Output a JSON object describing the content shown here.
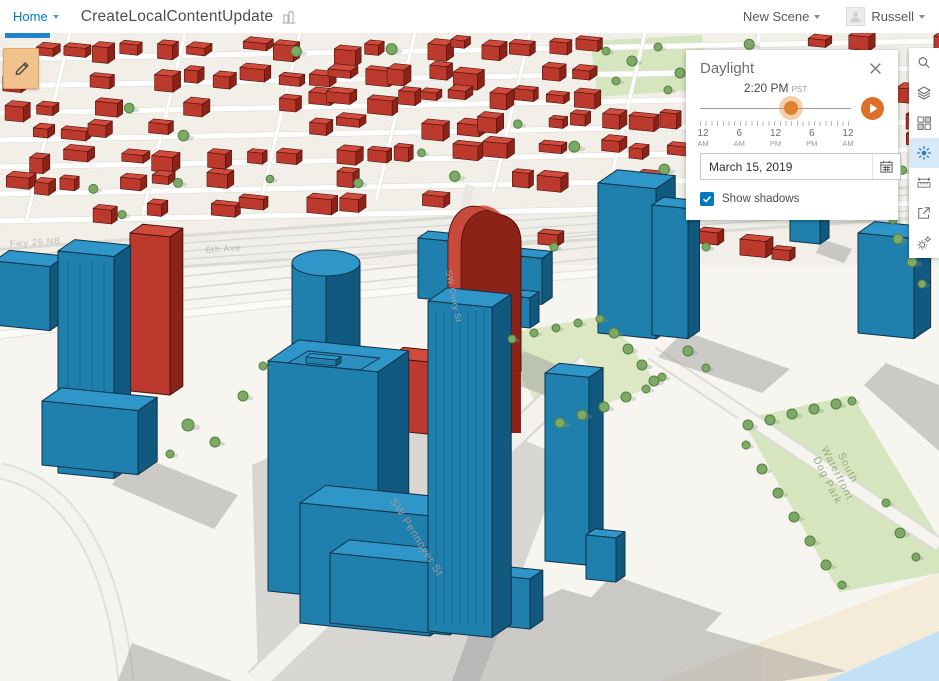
{
  "header": {
    "home_label": "Home",
    "scene_title": "CreateLocalContentUpdate",
    "new_scene_label": "New Scene",
    "user_name": "Russell"
  },
  "daylight": {
    "title": "Daylight",
    "time_value": "2:20 PM",
    "time_zone": "PST",
    "tick_labels": [
      {
        "n": "12",
        "m": "AM"
      },
      {
        "n": "6",
        "m": "AM"
      },
      {
        "n": "12",
        "m": "PM"
      },
      {
        "n": "6",
        "m": "PM"
      },
      {
        "n": "12",
        "m": "AM"
      }
    ],
    "date_value": "March 15, 2019",
    "show_shadows_label": "Show shadows"
  },
  "toolbar": {
    "items": [
      {
        "icon": "search-icon"
      },
      {
        "icon": "layers-icon"
      },
      {
        "icon": "basemap-icon"
      },
      {
        "icon": "daylight-icon",
        "active": true
      },
      {
        "icon": "measure-icon"
      },
      {
        "icon": "share-icon"
      },
      {
        "icon": "settings-icon"
      }
    ]
  },
  "scene": {
    "street_labels": {
      "freeway": "Fwy 26 NB",
      "ave": "6th Ave",
      "curry": "SW Curry St",
      "pennoyer": "SW Pennoyer St"
    },
    "park_label": [
      "South",
      "Waterfront",
      "Dog Park"
    ]
  },
  "colors": {
    "accent_blue": "#0079c1",
    "building_blue": "#1f7fad",
    "building_red": "#bc392d",
    "active_tool_bg": "#d7e9f6",
    "play_orange": "#dd6f28",
    "edit_tool_orange": "#f2c28c"
  }
}
